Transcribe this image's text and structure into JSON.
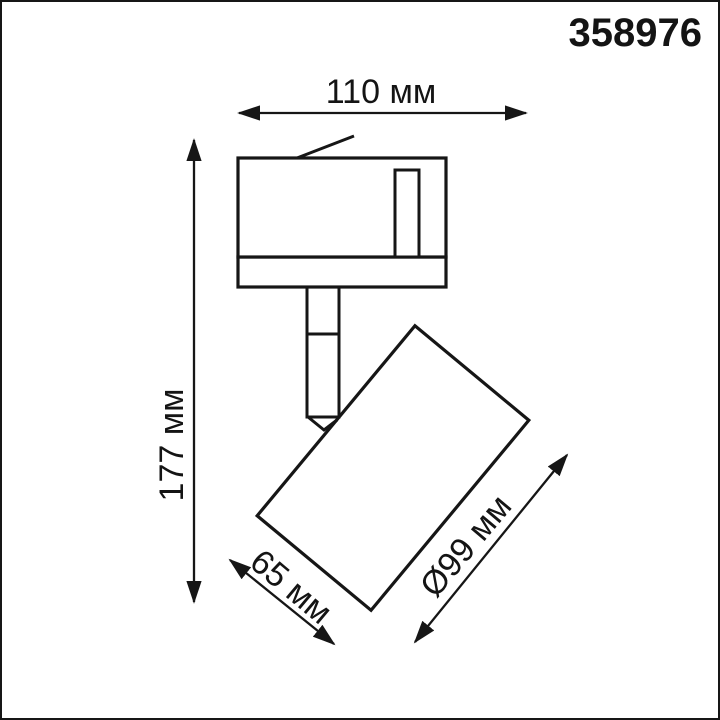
{
  "product_code": "358976",
  "dimensions": {
    "width": "110 мм",
    "height": "177 мм",
    "length": "65 мм",
    "diameter": "Ø99 мм"
  },
  "colors": {
    "line": "#161616",
    "text": "#141414",
    "background": "#ffffff"
  },
  "drawing_parts": {
    "track_adapter": "track-adapter",
    "lamp_head": "lamp-head-cylinder",
    "stem": "swivel-stem"
  }
}
